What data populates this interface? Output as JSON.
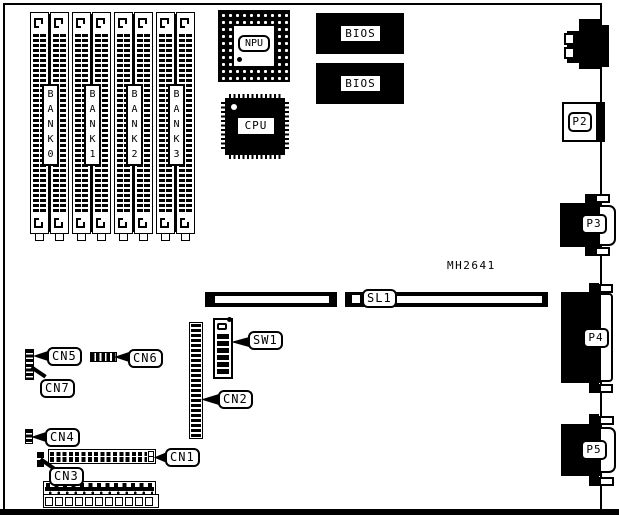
{
  "board": {
    "part_number": "MH2641"
  },
  "colors": {
    "ink": "#000000",
    "paper": "#ffffff"
  },
  "banks": [
    "B\nA\nN\nK\n0",
    "B\nA\nN\nK\n1",
    "B\nA\nN\nK\n2",
    "B\nA\nN\nK\n3"
  ],
  "chips": {
    "npu": "NPU",
    "cpu": "CPU",
    "bios_top": "BIOS",
    "bios_bottom": "BIOS"
  },
  "slots": {
    "sl1": "SL1"
  },
  "ports": {
    "p2": "P2",
    "p3": "P3",
    "p4": "P4",
    "p5": "P5"
  },
  "callouts": {
    "cn1": "CN1",
    "cn2": "CN2",
    "cn3": "CN3",
    "cn4": "CN4",
    "cn5": "CN5",
    "cn6": "CN6",
    "cn7": "CN7",
    "sw1": "SW1"
  }
}
